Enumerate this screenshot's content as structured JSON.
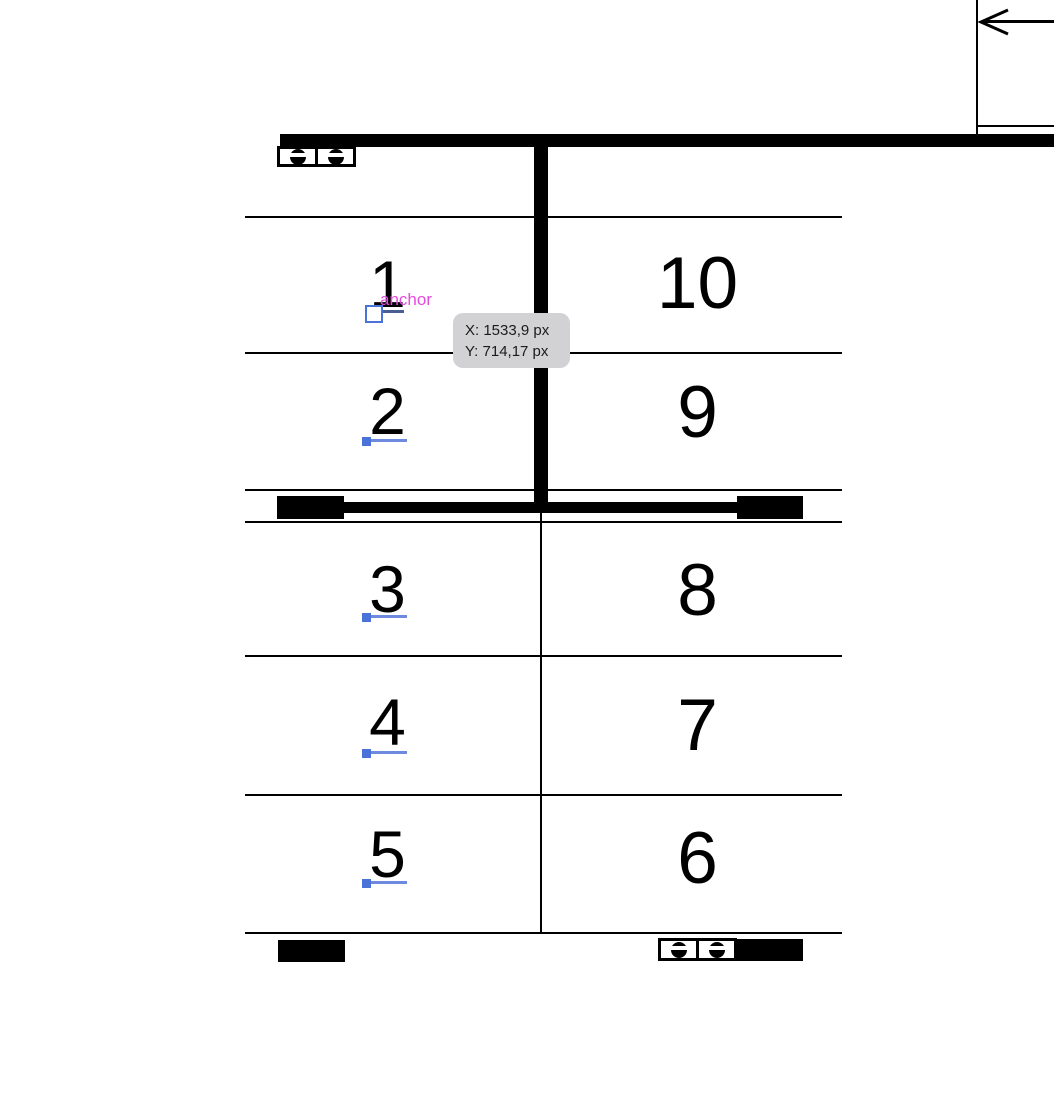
{
  "canvas": {
    "background": "#ffffff"
  },
  "colors": {
    "line_black": "#000000",
    "anchor_handle_blue": "#4b72d8",
    "anchor_underline_blue": "#6d8ade",
    "row1_underline_blue": "#4a5f91",
    "anchor_label_magenta": "#e44be0",
    "tooltip_bg": "#d2d2d4",
    "tooltip_text": "#1b1b1d"
  },
  "stalls": {
    "left": [
      {
        "label": "1"
      },
      {
        "label": "2"
      },
      {
        "label": "3"
      },
      {
        "label": "4"
      },
      {
        "label": "5"
      }
    ],
    "right": [
      {
        "label": "10"
      },
      {
        "label": "9"
      },
      {
        "label": "8"
      },
      {
        "label": "7"
      },
      {
        "label": "6"
      }
    ]
  },
  "annotations": {
    "anchor_label": "anchor",
    "tooltip": {
      "x_readout": "X: 1533,9 px",
      "y_readout": "Y: 714,17 px"
    }
  },
  "icons": {
    "sockets": "slotted-circle-socket-icon",
    "arrow": "arrow-left-icon"
  }
}
